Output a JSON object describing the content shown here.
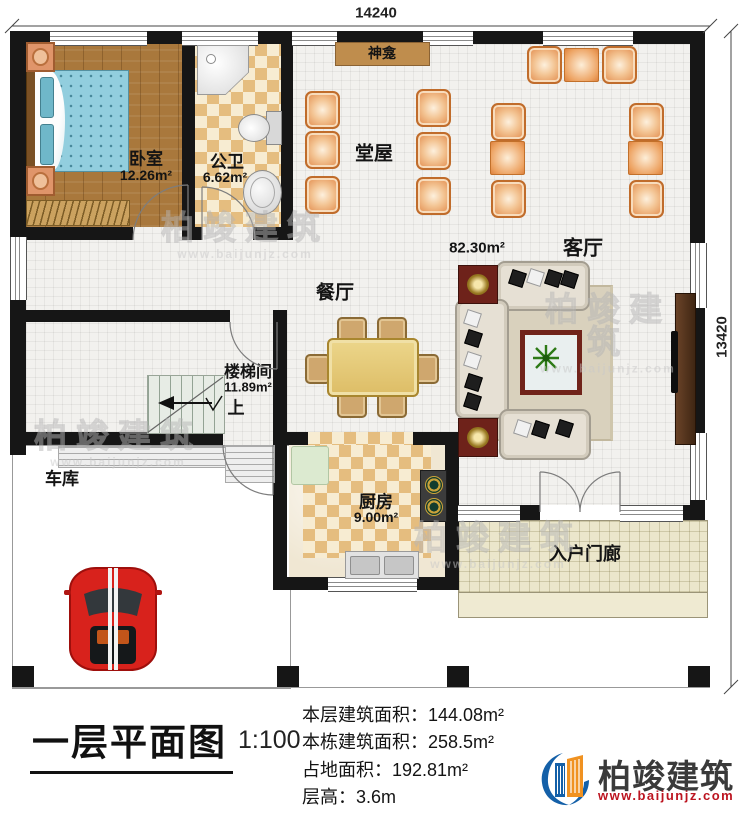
{
  "dimensions": {
    "top": "14240",
    "right": "13420"
  },
  "rooms": {
    "bedroom": {
      "label": "卧室",
      "area": "12.26m²"
    },
    "bathroom": {
      "label": "公卫",
      "area": "6.62m²"
    },
    "shrine": {
      "label": "神龛"
    },
    "hall": {
      "label": "堂屋"
    },
    "living_room": {
      "label": "客厅",
      "area": "82.30m²"
    },
    "dining_room": {
      "label": "餐厅"
    },
    "stairwell": {
      "label": "楼梯间",
      "area": "11.89m²",
      "direction": "上"
    },
    "garage": {
      "label": "车库"
    },
    "kitchen": {
      "label": "厨房",
      "area": "9.00m²"
    },
    "porch": {
      "label": "入户门廊"
    }
  },
  "title_block": {
    "title": "一层平面图",
    "scale": "1:100",
    "info": [
      {
        "label": "本层建筑面积：",
        "value": "144.08m²"
      },
      {
        "label": "本栋建筑面积：",
        "value": "258.5m²"
      },
      {
        "label": "占地面积：",
        "value": "192.81m²"
      },
      {
        "label": "层高：",
        "value": "3.6m"
      }
    ]
  },
  "logo": {
    "name": "柏竣建筑",
    "website": "www.baijunjz.com"
  },
  "watermark": {
    "name": "柏竣建筑",
    "website": "www.baijunjz.com"
  },
  "colors": {
    "accent_blue": "#1460a8",
    "accent_orange": "#f09221",
    "logo_red": "#bc1420"
  }
}
